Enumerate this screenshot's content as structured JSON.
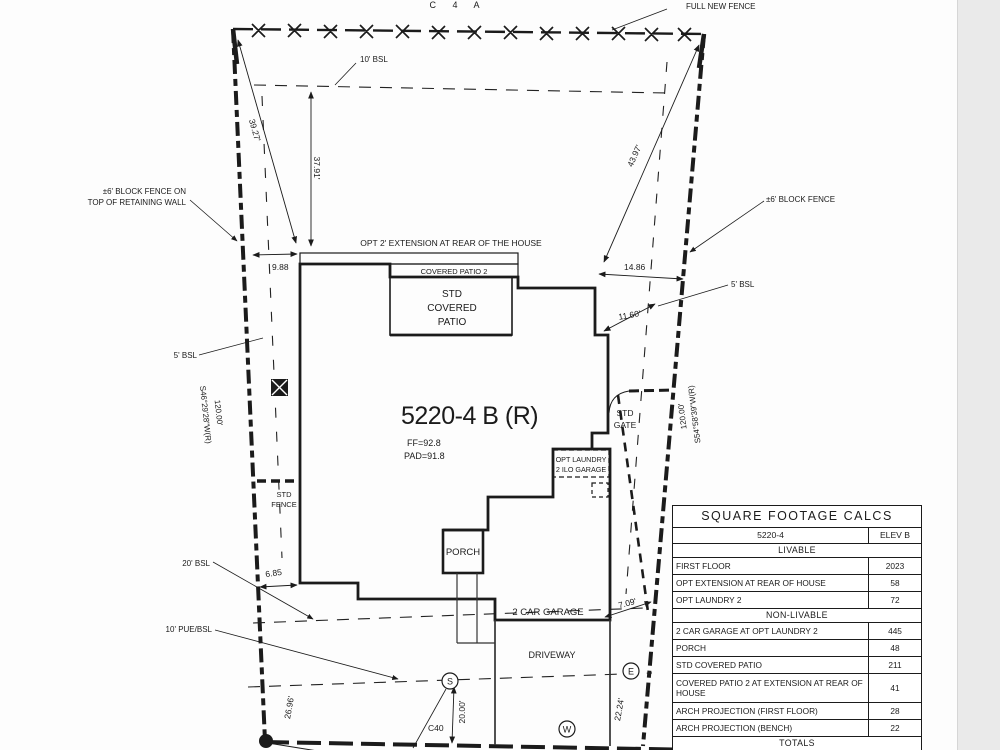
{
  "page": {
    "background": "#fdfdfd",
    "line_color": "#1b1b1b",
    "margin_strip_color": "#eaeaea"
  },
  "labels": {
    "c4a": "C 4 A",
    "full_new_fence": "FULL NEW FENCE",
    "bsl10_top": "10' BSL",
    "block_fence_left_1": "±6' BLOCK FENCE ON",
    "block_fence_left_2": "TOP OF RETAINING WALL",
    "block_fence_right": "±6' BLOCK FENCE",
    "bsl5_left": "5' BSL",
    "bsl5_right": "5' BSL",
    "opt_extension": "OPT 2' EXTENSION AT REAR OF THE HOUSE",
    "covered_patio_2": "COVERED PATIO 2",
    "std_covered_patio_1": "STD",
    "std_covered_patio_2": "COVERED",
    "std_covered_patio_3": "PATIO",
    "plan_id": "5220-4 B (R)",
    "ff": "FF=92.8",
    "pad": "PAD=91.8",
    "std_gate_1": "STD",
    "std_gate_2": "GATE",
    "opt_laundry_1": "OPT LAUNDRY",
    "opt_laundry_2": "2 ILO GARAGE",
    "bearing_left_1": "S46°29'28\"W(R)",
    "bearing_left_2": "120.00'",
    "bearing_right_1": "S54°58'39\"W(R)",
    "bearing_right_2": "120.00'",
    "std_fence_1": "STD",
    "std_fence_2": "FENCE",
    "porch": "PORCH",
    "garage": "2 CAR GARAGE",
    "driveway": "DRIVEWAY",
    "bsl20": "20' BSL",
    "pue10": "10' PUE/BSL",
    "c40": "C40",
    "marker_s": "S",
    "marker_w": "W",
    "marker_e": "E"
  },
  "dims": {
    "d39_27": "39.27'",
    "d37_91": "37.91'",
    "d43_97": "43.97'",
    "d9_88": "9.88",
    "d14_86": "14.86",
    "d11_60": "11.60'",
    "d7_09": "7.09'",
    "d6_85": "6.85",
    "d26_96": "26.96'",
    "d20_00": "20.00'",
    "d22_24": "22.24'"
  },
  "table": {
    "title": "SQUARE FOOTAGE CALCS",
    "model": "5220-4",
    "elev": "ELEV B",
    "section_livable": "LIVABLE",
    "livable_rows": [
      {
        "label": "FIRST FLOOR",
        "value": "2023"
      },
      {
        "label": "OPT EXTENSION AT REAR OF HOUSE",
        "value": "58"
      },
      {
        "label": "OPT LAUNDRY 2",
        "value": "72"
      }
    ],
    "section_nonlivable": "NON-LIVABLE",
    "nonlivable_rows": [
      {
        "label": "2 CAR GARAGE AT OPT LAUNDRY 2",
        "value": "445"
      },
      {
        "label": "PORCH",
        "value": "48"
      },
      {
        "label": "STD COVERED PATIO",
        "value": "211"
      },
      {
        "label": "COVERED PATIO 2 AT EXTENSION AT REAR OF HOUSE",
        "value": "41"
      },
      {
        "label": "ARCH PROJECTION (FIRST FLOOR)",
        "value": "28"
      },
      {
        "label": "ARCH PROJECTION (BENCH)",
        "value": "22"
      }
    ],
    "section_totals": "TOTALS",
    "partial_row": {
      "label": "MAX UNITS ROOF",
      "value": "2043"
    }
  }
}
